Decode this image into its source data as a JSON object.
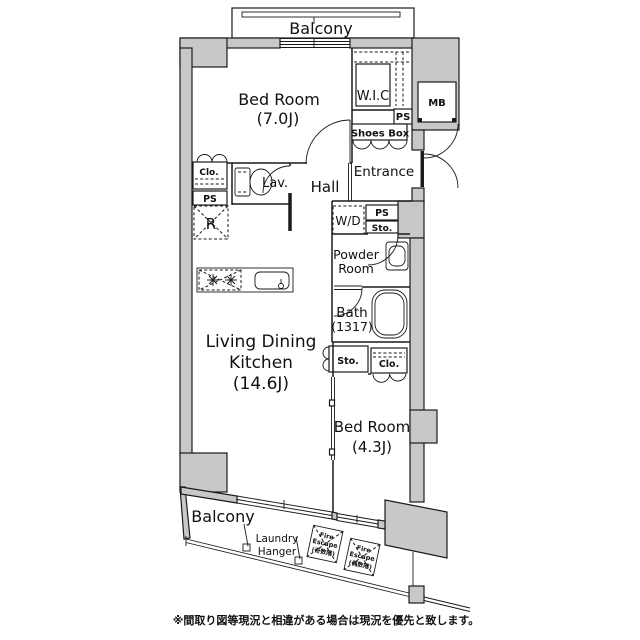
{
  "plan": {
    "balcony_top": "Balcony",
    "bedroom_main": {
      "label": "Bed Room",
      "size": "(7.0J)"
    },
    "wic": "W.I.C",
    "mb": "MB",
    "ps_top": "PS",
    "shoes_box": "Shoes Box",
    "entrance": "Entrance",
    "closet_main": "Clo.",
    "ps_left": "PS",
    "lavatory": "Lav.",
    "hall": "Hall",
    "refrigerator": "R",
    "washer_dryer": "W/D",
    "ps_mid": "PS",
    "storage_mid": "Sto.",
    "powder_room": {
      "line1": "Powder",
      "line2": "Room"
    },
    "bath": {
      "label": "Bath",
      "size": "(1317)"
    },
    "storage_ldk": "Sto.",
    "closet_bed2": "Clo.",
    "ldk": {
      "line1": "Living Dining",
      "line2": "Kitchen",
      "size": "(14.6J)"
    },
    "bedroom_second": {
      "label": "Bed Room",
      "size": "(4.3J)"
    },
    "balcony_bottom": "Balcony",
    "laundry_hanger": {
      "line1": "Laundry",
      "line2": "Hanger"
    },
    "fire_escape_odd": {
      "line1": "Fire",
      "line2": "Escape",
      "line3": "(奇数階)"
    },
    "fire_escape_even": {
      "line1": "Fire",
      "line2": "Escape",
      "line3": "(偶数階)"
    },
    "footnote": "※間取り図等現況と相違がある場合は現況を優先と致します。"
  },
  "colors": {
    "wall_fill": "#c8c8c8",
    "line": "#1a1a1a",
    "background": "#ffffff"
  }
}
